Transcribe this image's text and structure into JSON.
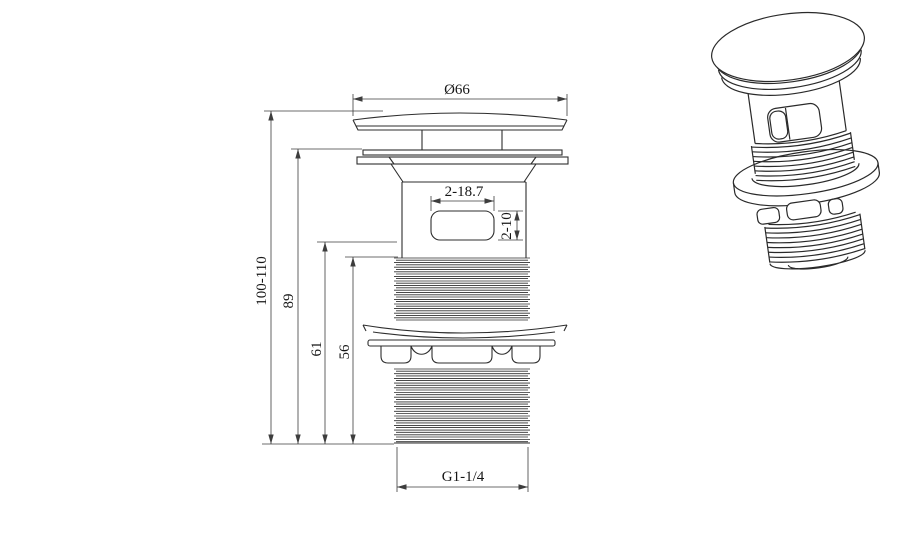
{
  "dimensions": {
    "cap_diameter": "Ø66",
    "overall_height": "100-110",
    "flange_to_bottom": "89",
    "overflow_to_bottom": "61",
    "thread_to_bottom": "56",
    "overflow_slot_width": "2-18.7",
    "overflow_slot_height": "2-10",
    "bottom_thread_spec": "G1-1/4"
  },
  "colors": {
    "background": "#ffffff",
    "object_line": "#2e2e2e",
    "dimension_line": "#3d3d3d",
    "text": "#161616"
  }
}
